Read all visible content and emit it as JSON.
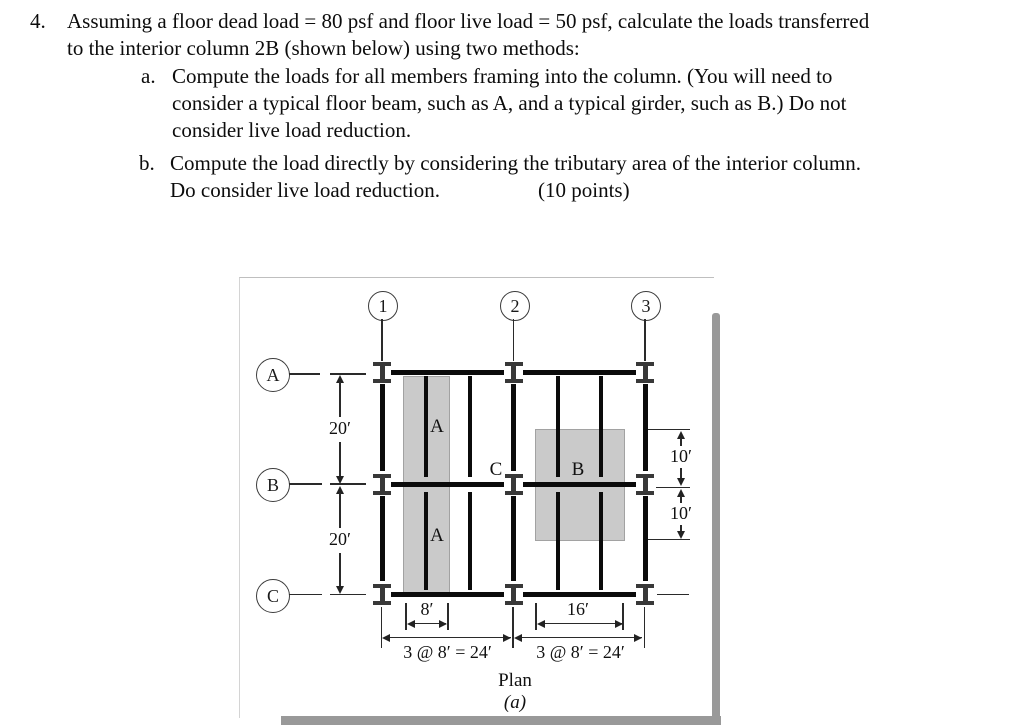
{
  "problem": {
    "number": "4.",
    "intro": [
      "Assuming a floor dead load = 80 psf and floor live load = 50 psf, calculate the loads transferred",
      "to the interior column 2B (shown below) using two methods:"
    ],
    "item_a": {
      "marker": "a.",
      "lines": [
        "Compute the loads for all members framing into the column. (You will need to",
        "consider a typical floor beam, such as A, and a typical girder, such as B.) Do not",
        "consider live load reduction."
      ]
    },
    "item_b": {
      "marker": "b.",
      "lines": [
        "Compute the load directly by considering the tributary area of the interior column.",
        "Do consider live load reduction."
      ],
      "points": "(10 points)"
    }
  },
  "diagram": {
    "grid_columns": [
      {
        "label": "1"
      },
      {
        "label": "2"
      },
      {
        "label": "3"
      }
    ],
    "grid_rows": [
      {
        "label": "A"
      },
      {
        "label": "B"
      },
      {
        "label": "C"
      }
    ],
    "dimensions": {
      "ab_spacing": "20′",
      "bc_spacing": "20′",
      "upper_right": "10′",
      "lower_right": "10′",
      "beam_trib_width": "8′",
      "girder_trib_width": "16′",
      "left_bay": "3 @ 8′ = 24′",
      "right_bay": "3 @ 8′ = 24′"
    },
    "members": {
      "floor_beam_upper": "A",
      "floor_beam_lower": "A",
      "girder": "B",
      "column_ref": "C"
    },
    "caption": {
      "title": "Plan",
      "figure": "(a)"
    },
    "colors": {
      "shading": "#cacaca",
      "member": "#0b0b0b"
    }
  }
}
